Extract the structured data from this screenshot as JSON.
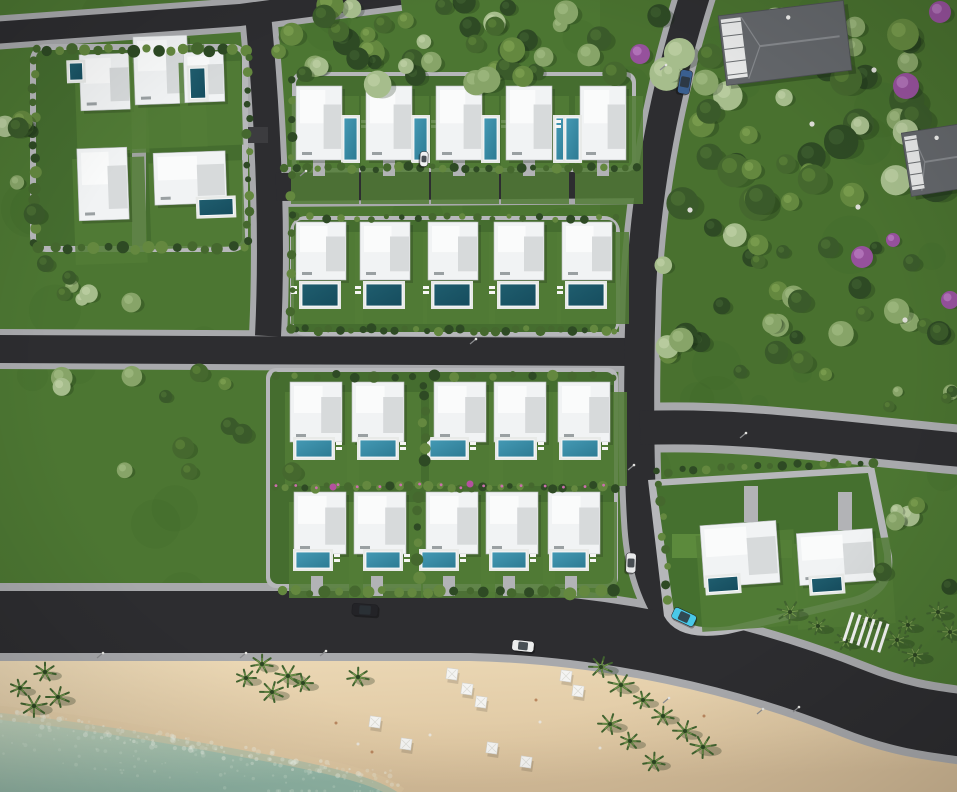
{
  "scene": {
    "width": 957,
    "height": 792,
    "description": "Aerial 3D render of a beachfront villa development with pools, road network, forest park and sandy beach with sea"
  },
  "palette": {
    "grass": "#4c7632",
    "grassDark": "#3e6428",
    "grassLight": "#567f3a",
    "pad": "#b6b7ba",
    "walk": "#a8a9ac",
    "asphalt": "#2d2d30",
    "laneAsphalt": "#3c3c3f",
    "sandTop": "#ecd9b6",
    "sandLow": "#e0c9a4",
    "sandCorner": "#d5bd99",
    "seaNear": "#c3d4bd",
    "seaFar": "#8fb4a4",
    "foam": "#edf3e8",
    "sparkle": "#d7e6d6",
    "houseWhite": "#f1f3f4",
    "houseHi": "#fafbfb",
    "houseShade": "#d7dadb",
    "houseEdge": "#b9bdbf",
    "poolDark": "#1f5d6e",
    "poolDark2": "#164d5e",
    "poolMid": "#2d7b93",
    "poolHi": "#4499b4",
    "deck": "#e8eae8",
    "shadow": "#1c2a16",
    "roofGray": "#63666a",
    "roofLight": "#85888c",
    "terrace": "#e6e7e7",
    "palmDark": "#41632f",
    "palmLight": "#71944a",
    "palmCore": "#2c4521",
    "pink": "#cc6fae",
    "rock": "#dcdcd6",
    "driveway": "#b2b3b6",
    "pole": "#8b8c8f"
  },
  "treePalette": [
    [
      "#2e4a24",
      "#3e5e2f"
    ],
    [
      "#45682e",
      "#5b8038"
    ],
    [
      "#64883f",
      "#7da051"
    ],
    [
      "#87a468",
      "#9fba80"
    ],
    [
      "#a6bd8c",
      "#bdd0a4"
    ],
    [
      "#3a5a2a",
      "#4c7034"
    ]
  ],
  "roads": [
    {
      "name": "top-road",
      "d": "M -8,33 L 240,15 L 400,-6",
      "w": 22,
      "sw": 34
    },
    {
      "name": "west-vertical-road",
      "d": "M 258,14 C 268,120 273,230 268,336",
      "w": 26,
      "sw": 38
    },
    {
      "name": "mid-cross-road",
      "d": "M -8,349 L 648,352",
      "w": 28,
      "sw": 40
    },
    {
      "name": "row1-street",
      "d": "M 276,187 L 652,184",
      "w": 28,
      "sw": 40
    },
    {
      "name": "main-diagonal-road",
      "d": "M 696,-8 C 668,80 646,180 641,290 C 638,380 639,470 642,520 C 644,560 653,592 672,620",
      "w": 30,
      "sw": 42
    },
    {
      "name": "east-road",
      "d": "M 640,428 C 740,424 830,438 962,450",
      "w": 34,
      "sw": 50
    },
    {
      "name": "coastal-road",
      "d": "M -8,622 L 470,622 C 610,625 745,656 855,700 C 905,720 940,722 965,726",
      "w": 62,
      "sw": 78
    },
    {
      "name": "compound-lane",
      "d": "M 40,136 L 268,135",
      "w": 16,
      "sw": 24,
      "lane": true
    }
  ],
  "pads": [
    {
      "name": "compound-pad",
      "x": 30,
      "y": 44,
      "w": 218,
      "h": 208,
      "rx": 16
    },
    {
      "name": "row1-pad",
      "x": 292,
      "y": 72,
      "w": 344,
      "h": 100,
      "rx": 10
    },
    {
      "name": "row2-pad",
      "x": 290,
      "y": 216,
      "w": 330,
      "h": 120,
      "rx": 16
    },
    {
      "name": "rows34-pad",
      "x": 266,
      "y": 368,
      "w": 352,
      "h": 220,
      "rx": 10
    }
  ],
  "padPaths": [
    {
      "name": "parcel-pad",
      "d": "M 648,480 L 874,466 L 892,556 Q 896,598 848,606 L 728,634 Q 678,642 664,616 Z"
    }
  ],
  "gardens": [
    {
      "x": 36,
      "y": 50,
      "w": 206,
      "h": 196
    },
    {
      "x": 296,
      "y": 76,
      "w": 336,
      "h": 92
    },
    {
      "x": 294,
      "y": 220,
      "w": 322,
      "h": 112
    },
    {
      "x": 270,
      "y": 372,
      "w": 344,
      "h": 212
    }
  ],
  "gardenPaths": [
    {
      "name": "parcel-garden",
      "d": "M 656,486 L 868,473 L 884,554 Q 887,592 844,599 L 730,626 Q 686,632 674,612 Z"
    }
  ],
  "lawns": [
    {
      "x": 672,
      "y": 534,
      "w": 30,
      "h": 24
    },
    {
      "x": 766,
      "y": 540,
      "w": 26,
      "h": 18
    }
  ],
  "villas": [
    {
      "x": 296,
      "y": 86,
      "w": 46,
      "h": 74,
      "pool": [
        344,
        118,
        13,
        42
      ],
      "pside": "r"
    },
    {
      "x": 366,
      "y": 86,
      "w": 46,
      "h": 74,
      "pool": [
        414,
        118,
        13,
        42
      ],
      "pside": "r"
    },
    {
      "x": 436,
      "y": 86,
      "w": 46,
      "h": 74,
      "pool": [
        484,
        118,
        13,
        42
      ],
      "pside": "r"
    },
    {
      "x": 506,
      "y": 86,
      "w": 46,
      "h": 74,
      "pool": [
        556,
        118,
        13,
        42
      ],
      "pside": "r"
    },
    {
      "x": 580,
      "y": 86,
      "w": 46,
      "h": 74,
      "pool": [
        566,
        118,
        13,
        42
      ],
      "pside": "l"
    },
    {
      "x": 296,
      "y": 222,
      "w": 50,
      "h": 58,
      "pool": [
        302,
        284,
        36,
        22
      ],
      "dark": true,
      "pside": "l"
    },
    {
      "x": 360,
      "y": 222,
      "w": 50,
      "h": 58,
      "pool": [
        366,
        284,
        36,
        22
      ],
      "dark": true,
      "pside": "l"
    },
    {
      "x": 428,
      "y": 222,
      "w": 50,
      "h": 58,
      "pool": [
        434,
        284,
        36,
        22
      ],
      "dark": true,
      "pside": "l"
    },
    {
      "x": 494,
      "y": 222,
      "w": 50,
      "h": 58,
      "pool": [
        500,
        284,
        36,
        22
      ],
      "dark": true,
      "pside": "l"
    },
    {
      "x": 562,
      "y": 222,
      "w": 50,
      "h": 58,
      "pool": [
        568,
        284,
        36,
        22
      ],
      "dark": true,
      "pside": "l"
    },
    {
      "x": 290,
      "y": 382,
      "w": 52,
      "h": 60,
      "pool": [
        296,
        440,
        36,
        17
      ],
      "pside": "r"
    },
    {
      "x": 352,
      "y": 382,
      "w": 52,
      "h": 60,
      "pool": [
        360,
        440,
        36,
        17
      ],
      "pside": "r"
    },
    {
      "x": 434,
      "y": 382,
      "w": 52,
      "h": 60,
      "pool": [
        430,
        440,
        36,
        17
      ],
      "pside": "r"
    },
    {
      "x": 494,
      "y": 382,
      "w": 52,
      "h": 60,
      "pool": [
        498,
        440,
        36,
        17
      ],
      "pside": "r"
    },
    {
      "x": 558,
      "y": 382,
      "w": 52,
      "h": 60,
      "pool": [
        562,
        440,
        36,
        17
      ],
      "pside": "r"
    },
    {
      "x": 294,
      "y": 492,
      "w": 52,
      "h": 62,
      "pool": [
        296,
        552,
        34,
        16
      ],
      "drive": true,
      "pside": "r"
    },
    {
      "x": 354,
      "y": 492,
      "w": 52,
      "h": 62,
      "pool": [
        366,
        552,
        34,
        16
      ],
      "drive": true,
      "pside": "r"
    },
    {
      "x": 426,
      "y": 492,
      "w": 52,
      "h": 62,
      "pool": [
        422,
        552,
        34,
        16
      ],
      "drive": true,
      "pside": "r"
    },
    {
      "x": 486,
      "y": 492,
      "w": 52,
      "h": 62,
      "pool": [
        492,
        552,
        34,
        16
      ],
      "drive": true,
      "pside": "r"
    },
    {
      "x": 548,
      "y": 492,
      "w": 52,
      "h": 62,
      "pool": [
        552,
        552,
        34,
        16
      ],
      "drive": true,
      "pside": "r"
    },
    {
      "x": 702,
      "y": 523,
      "w": 76,
      "h": 62,
      "pool": [
        706,
        576,
        30,
        14
      ],
      "rot": -4,
      "dark": true
    },
    {
      "x": 798,
      "y": 531,
      "w": 76,
      "h": 52,
      "pool": [
        810,
        577,
        30,
        14
      ],
      "rot": -4,
      "dark": true
    },
    {
      "x": 80,
      "y": 54,
      "w": 50,
      "h": 56,
      "pool": [
        70,
        62,
        13,
        17
      ],
      "rot": -2,
      "dark": true
    },
    {
      "x": 134,
      "y": 36,
      "w": 54,
      "h": 68,
      "rot": -2
    },
    {
      "x": 184,
      "y": 52,
      "w": 40,
      "h": 50,
      "pool": [
        190,
        68,
        15,
        30
      ],
      "rot": -2,
      "dark": true
    },
    {
      "x": 78,
      "y": 148,
      "w": 50,
      "h": 72,
      "rot": -2
    },
    {
      "x": 154,
      "y": 152,
      "w": 72,
      "h": 52,
      "pool": [
        198,
        200,
        34,
        16
      ],
      "rot": -2,
      "dark": true
    }
  ],
  "driveRow1Y": 160,
  "driveRow4Y": 576,
  "parcelDrives": [
    {
      "x": 744,
      "y": 486,
      "w": 14,
      "h": 36
    },
    {
      "x": 838,
      "y": 492,
      "w": 14,
      "h": 38
    }
  ],
  "compoundPaths": [
    {
      "x": 132,
      "y": 50,
      "w": 14,
      "h": 196
    }
  ],
  "hedges": [
    [
      284,
      168,
      636,
      168,
      32,
      4,
      11
    ],
    [
      296,
      218,
      616,
      218,
      22,
      3.5,
      12
    ],
    [
      296,
      330,
      616,
      330,
      30,
      4,
      13
    ],
    [
      276,
      376,
      612,
      376,
      18,
      4.5,
      14
    ],
    [
      276,
      487,
      614,
      487,
      34,
      4,
      15
    ],
    [
      282,
      592,
      614,
      592,
      24,
      5,
      16
    ],
    [
      36,
      50,
      246,
      50,
      18,
      5,
      17
    ],
    [
      34,
      60,
      34,
      244,
      14,
      5,
      18
    ],
    [
      40,
      248,
      246,
      248,
      16,
      5,
      19
    ],
    [
      248,
      58,
      248,
      242,
      13,
      4,
      20
    ],
    [
      292,
      80,
      292,
      330,
      14,
      4,
      21
    ],
    [
      656,
      472,
      874,
      462,
      18,
      4,
      22
    ],
    [
      660,
      486,
      668,
      600,
      8,
      4,
      23
    ],
    [
      424,
      384,
      424,
      462,
      7,
      5,
      24
    ],
    [
      418,
      496,
      418,
      576,
      6,
      5,
      25
    ]
  ],
  "flowerHedgeIndex": 4,
  "flowerBushes": [
    {
      "x": 333,
      "y": 487
    },
    {
      "x": 470,
      "y": 484
    }
  ],
  "clusters": [
    {
      "name": "top-tree-band",
      "x": 262,
      "y": 2,
      "w": 392,
      "h": 84,
      "n": 46,
      "r0": 7,
      "r1": 14,
      "seed": 101
    },
    {
      "name": "forest-northeast",
      "x": 652,
      "y": 10,
      "w": 300,
      "h": 210,
      "n": 50,
      "r0": 8,
      "r1": 18,
      "seed": 102
    },
    {
      "name": "forest-east",
      "x": 655,
      "y": 225,
      "w": 298,
      "h": 155,
      "n": 36,
      "r0": 6,
      "r1": 13,
      "seed": 103
    },
    {
      "name": "meadow-left",
      "x": 6,
      "y": 372,
      "w": 288,
      "h": 104,
      "n": 12,
      "r0": 6,
      "r1": 11,
      "seed": 104
    },
    {
      "name": "left-edge-trees",
      "x": 0,
      "y": 86,
      "w": 38,
      "h": 130,
      "n": 6,
      "r0": 7,
      "r1": 11,
      "seed": 105
    },
    {
      "name": "mid-left-strip",
      "x": 40,
      "y": 256,
      "w": 200,
      "h": 66,
      "n": 7,
      "r0": 6,
      "r1": 10,
      "seed": 106
    },
    {
      "name": "east-right-shrubs",
      "x": 888,
      "y": 378,
      "w": 66,
      "h": 40,
      "n": 5,
      "r0": 5,
      "r1": 9,
      "seed": 107
    },
    {
      "name": "parcel-northeast-trees",
      "x": 876,
      "y": 470,
      "w": 78,
      "h": 126,
      "n": 7,
      "r0": 6,
      "r1": 12,
      "seed": 108
    }
  ],
  "purpleTrees": [
    [
      640,
      54,
      10
    ],
    [
      906,
      86,
      13
    ],
    [
      940,
      12,
      11
    ],
    [
      862,
      257,
      11
    ],
    [
      950,
      300,
      9
    ],
    [
      893,
      240,
      7
    ]
  ],
  "rocks": [
    [
      874,
      70
    ],
    [
      812,
      124
    ],
    [
      858,
      207
    ],
    [
      690,
      210
    ],
    [
      905,
      320
    ]
  ],
  "palms": [
    [
      20,
      688
    ],
    [
      45,
      672
    ],
    [
      58,
      697
    ],
    [
      34,
      706
    ],
    [
      246,
      678
    ],
    [
      262,
      664
    ],
    [
      272,
      692
    ],
    [
      288,
      676
    ],
    [
      303,
      683
    ],
    [
      358,
      677
    ],
    [
      601,
      667
    ],
    [
      621,
      685
    ],
    [
      643,
      700
    ],
    [
      663,
      716
    ],
    [
      685,
      731
    ],
    [
      703,
      747
    ],
    [
      630,
      741
    ],
    [
      654,
      762
    ],
    [
      610,
      724
    ],
    [
      790,
      612
    ],
    [
      818,
      626
    ],
    [
      846,
      641
    ],
    [
      897,
      640
    ],
    [
      915,
      655
    ],
    [
      908,
      625
    ],
    [
      938,
      612
    ],
    [
      950,
      632
    ],
    [
      870,
      620
    ]
  ],
  "umbrellas": [
    [
      452,
      674
    ],
    [
      467,
      689
    ],
    [
      481,
      702
    ],
    [
      375,
      722
    ],
    [
      406,
      744
    ],
    [
      566,
      676
    ],
    [
      578,
      691
    ],
    [
      492,
      748
    ],
    [
      526,
      762
    ]
  ],
  "people": [
    [
      336,
      723
    ],
    [
      358,
      744
    ],
    [
      372,
      752
    ],
    [
      430,
      735
    ],
    [
      536,
      700
    ],
    [
      600,
      748
    ],
    [
      704,
      716
    ],
    [
      540,
      722
    ]
  ],
  "beachLights": [
    [
      97,
      658
    ],
    [
      240,
      658
    ],
    [
      320,
      656
    ],
    [
      663,
      703
    ],
    [
      757,
      714
    ],
    [
      793,
      712
    ]
  ],
  "streetLights": [
    [
      300,
      176
    ],
    [
      470,
      344
    ],
    [
      740,
      438
    ],
    [
      660,
      70
    ],
    [
      628,
      470
    ]
  ],
  "cars": [
    {
      "name": "car-blue",
      "x": 685,
      "y": 82,
      "rot": 100,
      "c": "#3a5f8f",
      "len": 24,
      "wid": 12
    },
    {
      "name": "car-white-small",
      "x": 631,
      "y": 563,
      "rot": 92,
      "c": "#e8e9ea",
      "len": 20,
      "wid": 10
    },
    {
      "name": "car-dark",
      "x": 365,
      "y": 610,
      "rot": 4,
      "c": "#232327",
      "len": 26,
      "wid": 12
    },
    {
      "name": "car-white",
      "x": 523,
      "y": 646,
      "rot": 6,
      "c": "#eceded",
      "len": 22,
      "wid": 11
    },
    {
      "name": "car-cyan",
      "x": 684,
      "y": 617,
      "rot": 25,
      "c": "#49c8e8",
      "len": 24,
      "wid": 12
    },
    {
      "name": "car-parked",
      "x": 424,
      "y": 159,
      "rot": 92,
      "c": "#f0f1f2",
      "len": 15,
      "wid": 8
    }
  ],
  "grayHouses": [
    {
      "x": 722,
      "y": 8,
      "w": 126,
      "h": 70,
      "rot": -7
    },
    {
      "x": 906,
      "y": 128,
      "w": 62,
      "h": 64,
      "rot": -9
    }
  ],
  "pergola": {
    "x": 846,
    "y": 618,
    "w": 44,
    "h": 30,
    "rot": 18,
    "slats": 6
  },
  "sand": {
    "d": "M -8,656 L 470,658 C 610,661 700,680 800,706 C 870,724 920,738 965,758 L 965,794 L -8,794 Z"
  },
  "sea": {
    "d": "M -8,712 C 90,722 190,740 285,758 C 345,770 382,780 400,794 L -8,794 Z",
    "shore": "M -8,712 C 90,722 190,740 285,758 C 345,770 382,780 400,794",
    "foamN": 150,
    "sparkleN": 80,
    "seed": 77
  },
  "mottle": {
    "n": 60,
    "seed": 55
  }
}
